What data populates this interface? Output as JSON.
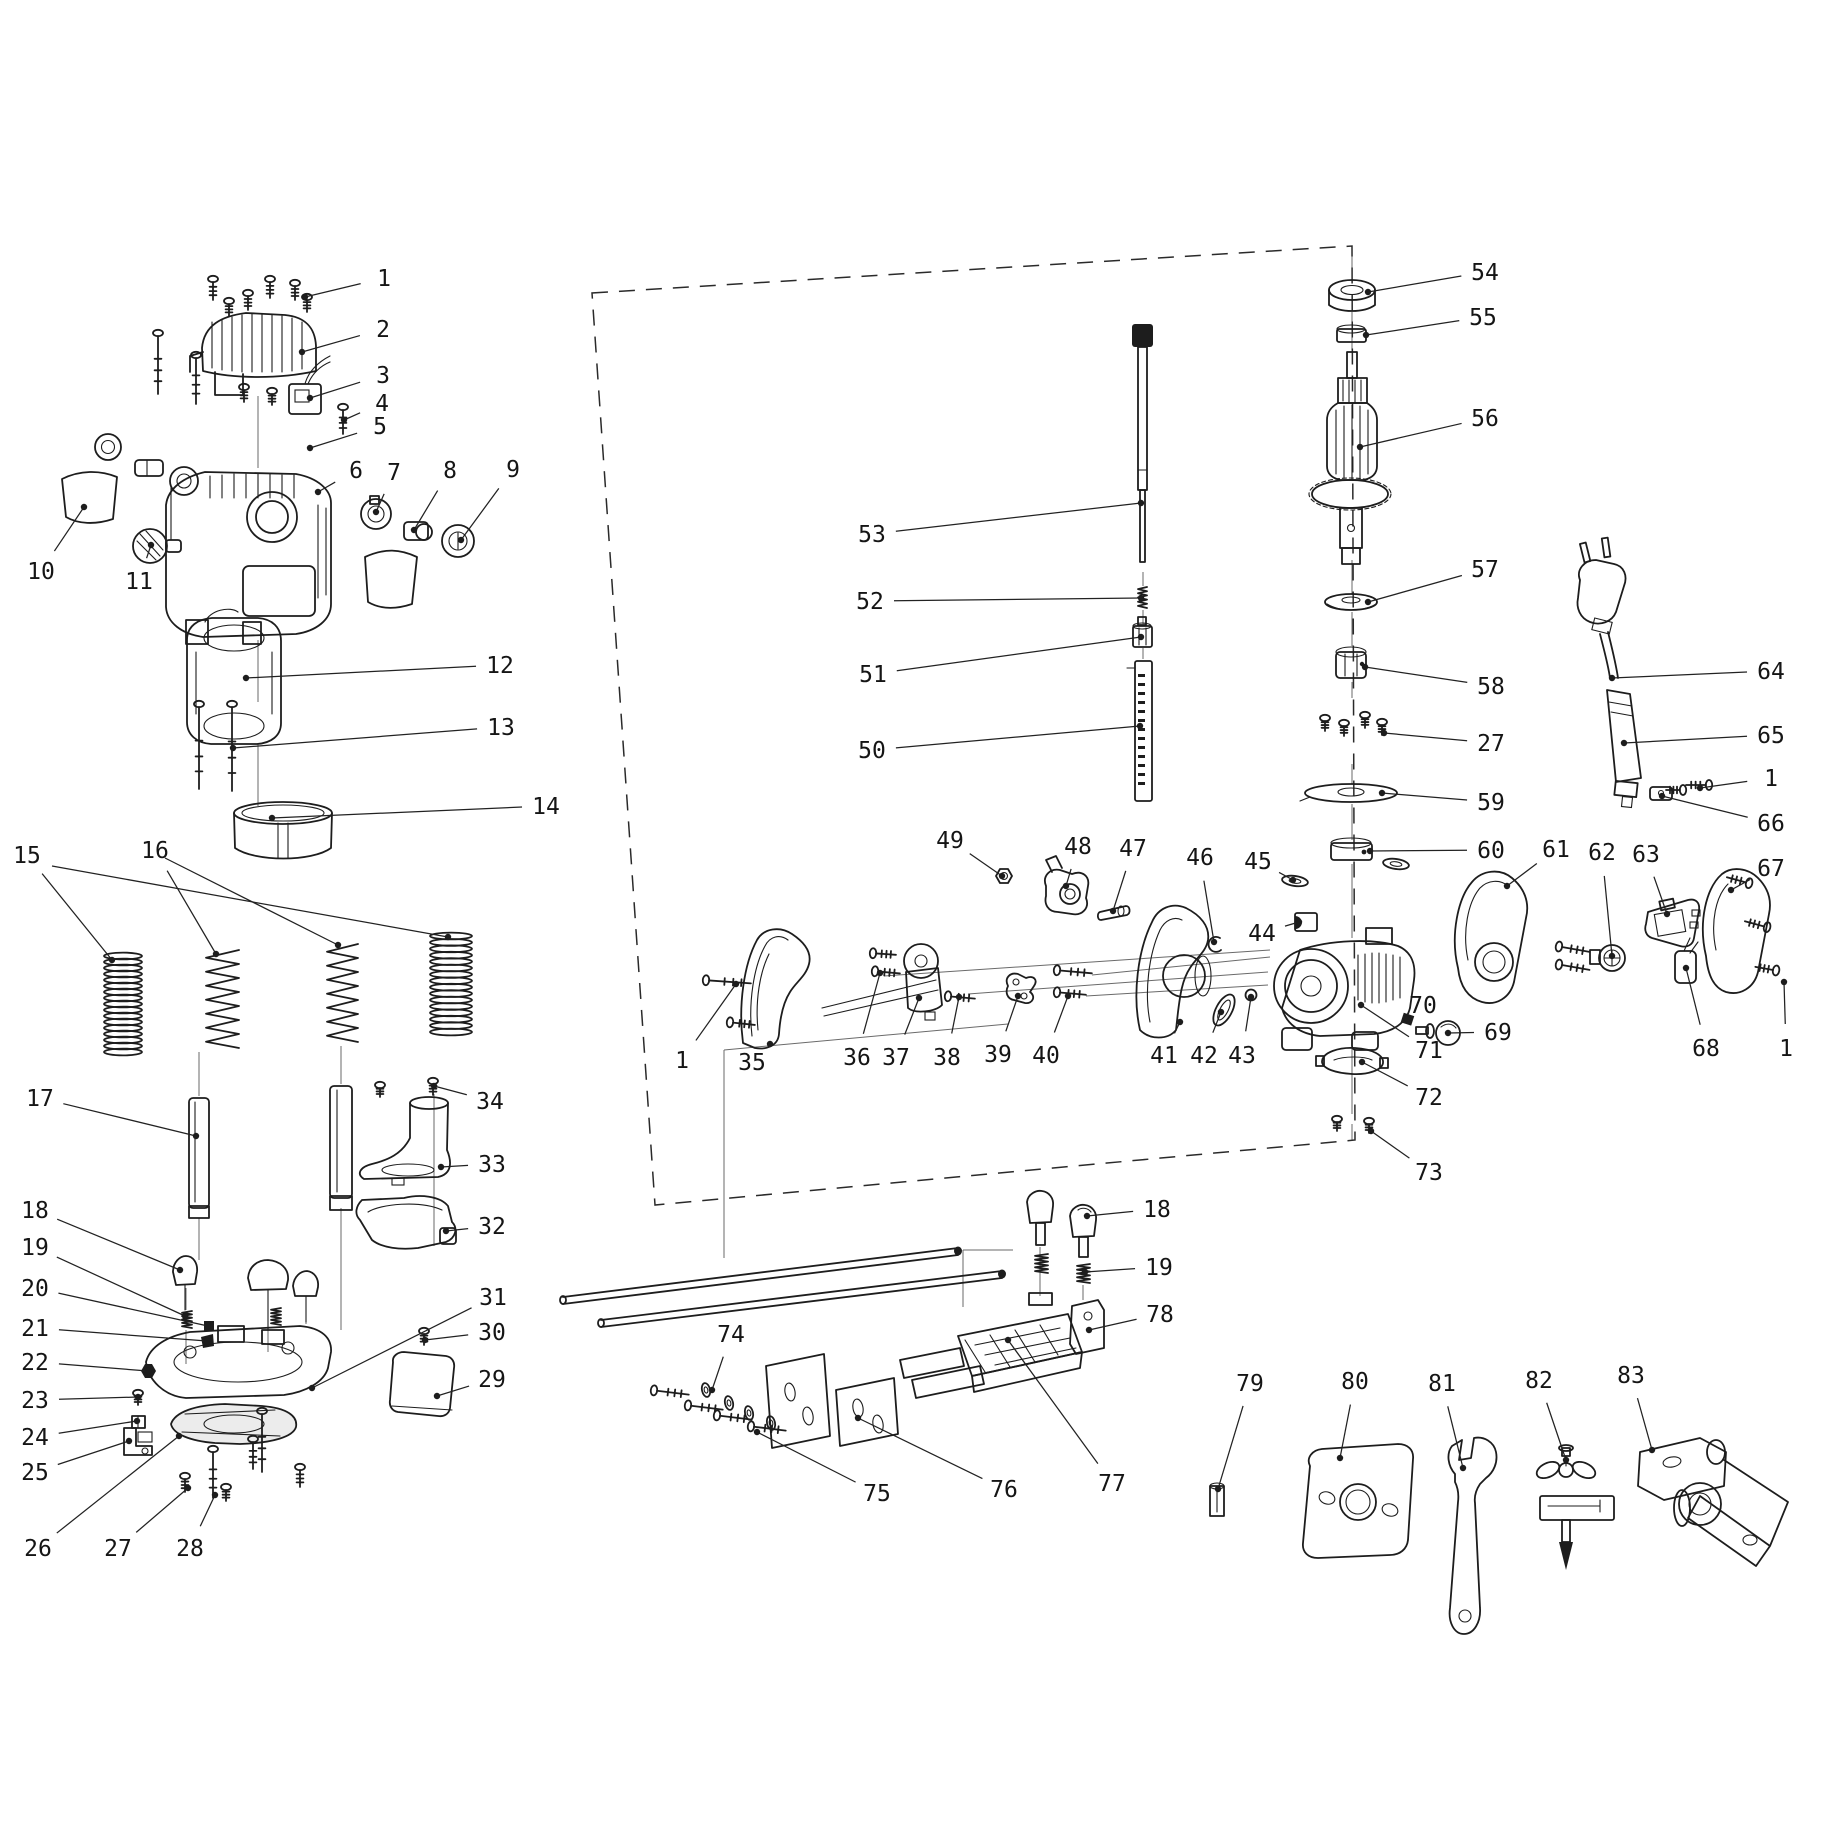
{
  "diagram": {
    "bg": "#ffffff",
    "ink": "#1d1d1d",
    "description_labels_are_part_numbers": true,
    "labels": [
      {
        "n": "1",
        "x": 384,
        "y": 278,
        "tx": 305,
        "ty": 297
      },
      {
        "n": "2",
        "x": 383,
        "y": 329,
        "tx": 302,
        "ty": 352
      },
      {
        "n": "3",
        "x": 383,
        "y": 375,
        "tx": 310,
        "ty": 398
      },
      {
        "n": "4",
        "x": 382,
        "y": 403,
        "tx": 344,
        "ty": 420
      },
      {
        "n": "5",
        "x": 380,
        "y": 426,
        "tx": 310,
        "ty": 448
      },
      {
        "n": "6",
        "x": 356,
        "y": 470,
        "tx": 318,
        "ty": 492
      },
      {
        "n": "7",
        "x": 394,
        "y": 472,
        "tx": 376,
        "ty": 512
      },
      {
        "n": "8",
        "x": 450,
        "y": 470,
        "tx": 414,
        "ty": 530
      },
      {
        "n": "9",
        "x": 513,
        "y": 469,
        "tx": 461,
        "ty": 540
      },
      {
        "n": "10",
        "x": 41,
        "y": 571,
        "tx": 84,
        "ty": 507
      },
      {
        "n": "11",
        "x": 139,
        "y": 581,
        "tx": 151,
        "ty": 545
      },
      {
        "n": "12",
        "x": 500,
        "y": 665,
        "tx": 246,
        "ty": 678
      },
      {
        "n": "13",
        "x": 501,
        "y": 727,
        "tx": 233,
        "ty": 748
      },
      {
        "n": "14",
        "x": 546,
        "y": 806,
        "tx": 272,
        "ty": 818
      },
      {
        "n": "15",
        "x": 27,
        "y": 855,
        "tx": 112,
        "ty": 960
      },
      {
        "n": "16",
        "x": 155,
        "y": 850,
        "tx": 216,
        "ty": 954
      },
      {
        "n": "17",
        "x": 40,
        "y": 1098,
        "tx": 196,
        "ty": 1136
      },
      {
        "n": "18",
        "x": 35,
        "y": 1210,
        "tx": 180,
        "ty": 1270
      },
      {
        "n": "19",
        "x": 35,
        "y": 1247,
        "tx": 185,
        "ty": 1316
      },
      {
        "n": "20",
        "x": 35,
        "y": 1288,
        "tx": 208,
        "ty": 1326
      },
      {
        "n": "21",
        "x": 35,
        "y": 1328,
        "tx": 207,
        "ty": 1341
      },
      {
        "n": "22",
        "x": 35,
        "y": 1362,
        "tx": 148,
        "ty": 1371
      },
      {
        "n": "23",
        "x": 35,
        "y": 1400,
        "tx": 138,
        "ty": 1397
      },
      {
        "n": "24",
        "x": 35,
        "y": 1437,
        "tx": 137,
        "ty": 1421
      },
      {
        "n": "25",
        "x": 35,
        "y": 1472,
        "tx": 129,
        "ty": 1441
      },
      {
        "n": "26",
        "x": 38,
        "y": 1548,
        "tx": 179,
        "ty": 1436
      },
      {
        "n": "27",
        "x": 118,
        "y": 1548,
        "tx": 188,
        "ty": 1488
      },
      {
        "n": "28",
        "x": 190,
        "y": 1548,
        "tx": 215,
        "ty": 1495
      },
      {
        "n": "29",
        "x": 492,
        "y": 1379,
        "tx": 437,
        "ty": 1396
      },
      {
        "n": "30",
        "x": 492,
        "y": 1332,
        "tx": 425,
        "ty": 1340
      },
      {
        "n": "31",
        "x": 493,
        "y": 1297,
        "tx": 312,
        "ty": 1388
      },
      {
        "n": "32",
        "x": 492,
        "y": 1226,
        "tx": 446,
        "ty": 1231
      },
      {
        "n": "33",
        "x": 492,
        "y": 1164,
        "tx": 441,
        "ty": 1167
      },
      {
        "n": "34",
        "x": 490,
        "y": 1101,
        "tx": 434,
        "ty": 1086
      },
      {
        "n": "1",
        "x": 682,
        "y": 1060,
        "tx": 736,
        "ty": 984
      },
      {
        "n": "35",
        "x": 752,
        "y": 1062,
        "tx": 770,
        "ty": 1044
      },
      {
        "n": "36",
        "x": 857,
        "y": 1057,
        "tx": 880,
        "ty": 973
      },
      {
        "n": "37",
        "x": 896,
        "y": 1057,
        "tx": 919,
        "ty": 998
      },
      {
        "n": "38",
        "x": 947,
        "y": 1057,
        "tx": 959,
        "ty": 997
      },
      {
        "n": "39",
        "x": 998,
        "y": 1054,
        "tx": 1018,
        "ty": 996
      },
      {
        "n": "40",
        "x": 1046,
        "y": 1055,
        "tx": 1068,
        "ty": 996
      },
      {
        "n": "41",
        "x": 1164,
        "y": 1055,
        "tx": 1180,
        "ty": 1022
      },
      {
        "n": "42",
        "x": 1204,
        "y": 1055,
        "tx": 1221,
        "ty": 1012
      },
      {
        "n": "43",
        "x": 1242,
        "y": 1055,
        "tx": 1251,
        "ty": 997
      },
      {
        "n": "44",
        "x": 1262,
        "y": 933,
        "tx": 1299,
        "ty": 922
      },
      {
        "n": "45",
        "x": 1258,
        "y": 861,
        "tx": 1293,
        "ty": 880
      },
      {
        "n": "46",
        "x": 1200,
        "y": 857,
        "tx": 1214,
        "ty": 942
      },
      {
        "n": "47",
        "x": 1133,
        "y": 848,
        "tx": 1113,
        "ty": 911
      },
      {
        "n": "48",
        "x": 1078,
        "y": 846,
        "tx": 1066,
        "ty": 886
      },
      {
        "n": "49",
        "x": 950,
        "y": 840,
        "tx": 1002,
        "ty": 876
      },
      {
        "n": "50",
        "x": 872,
        "y": 750,
        "tx": 1140,
        "ty": 726
      },
      {
        "n": "51",
        "x": 873,
        "y": 674,
        "tx": 1141,
        "ty": 637
      },
      {
        "n": "52",
        "x": 870,
        "y": 601,
        "tx": 1141,
        "ty": 598
      },
      {
        "n": "53",
        "x": 872,
        "y": 534,
        "tx": 1141,
        "ty": 503
      },
      {
        "n": "54",
        "x": 1485,
        "y": 272,
        "tx": 1368,
        "ty": 292
      },
      {
        "n": "55",
        "x": 1483,
        "y": 317,
        "tx": 1366,
        "ty": 335
      },
      {
        "n": "56",
        "x": 1485,
        "y": 418,
        "tx": 1360,
        "ty": 447
      },
      {
        "n": "57",
        "x": 1485,
        "y": 569,
        "tx": 1368,
        "ty": 602
      },
      {
        "n": "58",
        "x": 1491,
        "y": 686,
        "tx": 1365,
        "ty": 667
      },
      {
        "n": "27",
        "x": 1491,
        "y": 743,
        "tx": 1384,
        "ty": 733
      },
      {
        "n": "59",
        "x": 1491,
        "y": 802,
        "tx": 1382,
        "ty": 793
      },
      {
        "n": "60",
        "x": 1491,
        "y": 850,
        "tx": 1370,
        "ty": 851
      },
      {
        "n": "61",
        "x": 1556,
        "y": 849,
        "tx": 1507,
        "ty": 886
      },
      {
        "n": "62",
        "x": 1602,
        "y": 852,
        "tx": 1612,
        "ty": 956
      },
      {
        "n": "63",
        "x": 1646,
        "y": 854,
        "tx": 1667,
        "ty": 914
      },
      {
        "n": "64",
        "x": 1771,
        "y": 671,
        "tx": 1612,
        "ty": 678
      },
      {
        "n": "65",
        "x": 1771,
        "y": 735,
        "tx": 1624,
        "ty": 743
      },
      {
        "n": "1",
        "x": 1771,
        "y": 778,
        "tx": 1700,
        "ty": 788
      },
      {
        "n": "66",
        "x": 1771,
        "y": 823,
        "tx": 1662,
        "ty": 796
      },
      {
        "n": "67",
        "x": 1771,
        "y": 868,
        "tx": 1731,
        "ty": 890
      },
      {
        "n": "68",
        "x": 1706,
        "y": 1048,
        "tx": 1686,
        "ty": 968
      },
      {
        "n": "1",
        "x": 1786,
        "y": 1048,
        "tx": 1784,
        "ty": 982
      },
      {
        "n": "69",
        "x": 1498,
        "y": 1032,
        "tx": 1448,
        "ty": 1033
      },
      {
        "n": "70",
        "x": 1423,
        "y": 1005,
        "tx": 1407,
        "ty": 1019
      },
      {
        "n": "71",
        "x": 1429,
        "y": 1050,
        "tx": 1361,
        "ty": 1005
      },
      {
        "n": "72",
        "x": 1429,
        "y": 1097,
        "tx": 1362,
        "ty": 1062
      },
      {
        "n": "73",
        "x": 1429,
        "y": 1172,
        "tx": 1371,
        "ty": 1131
      },
      {
        "n": "18",
        "x": 1157,
        "y": 1209,
        "tx": 1087,
        "ty": 1216
      },
      {
        "n": "19",
        "x": 1159,
        "y": 1267,
        "tx": 1085,
        "ty": 1272
      },
      {
        "n": "78",
        "x": 1160,
        "y": 1314,
        "tx": 1089,
        "ty": 1330
      },
      {
        "n": "74",
        "x": 731,
        "y": 1334,
        "tx": 712,
        "ty": 1390
      },
      {
        "n": "75",
        "x": 877,
        "y": 1493,
        "tx": 757,
        "ty": 1432
      },
      {
        "n": "76",
        "x": 1004,
        "y": 1489,
        "tx": 858,
        "ty": 1418
      },
      {
        "n": "77",
        "x": 1112,
        "y": 1483,
        "tx": 1008,
        "ty": 1340
      },
      {
        "n": "79",
        "x": 1250,
        "y": 1383,
        "tx": 1218,
        "ty": 1489
      },
      {
        "n": "80",
        "x": 1355,
        "y": 1381,
        "tx": 1340,
        "ty": 1458
      },
      {
        "n": "81",
        "x": 1442,
        "y": 1383,
        "tx": 1463,
        "ty": 1468
      },
      {
        "n": "82",
        "x": 1539,
        "y": 1380,
        "tx": 1566,
        "ty": 1460
      },
      {
        "n": "83",
        "x": 1631,
        "y": 1375,
        "tx": 1652,
        "ty": 1450
      }
    ],
    "extra_leaders": [
      [
        52,
        866,
        448,
        937
      ],
      [
        165,
        858,
        338,
        945
      ]
    ],
    "dashed_box": [
      [
        592,
        293
      ],
      [
        1352,
        246
      ],
      [
        1355,
        1140
      ],
      [
        655,
        1205
      ]
    ],
    "axes": [
      [
        258,
        396,
        258,
        468
      ],
      [
        258,
        640,
        258,
        702
      ],
      [
        258,
        744,
        258,
        806
      ],
      [
        199,
        1052,
        199,
        1096
      ],
      [
        199,
        1218,
        199,
        1260
      ],
      [
        341,
        1046,
        341,
        1084
      ],
      [
        341,
        1208,
        341,
        1330
      ],
      [
        186,
        1288,
        186,
        1310
      ],
      [
        186,
        1330,
        186,
        1364
      ],
      [
        268,
        1292,
        268,
        1352
      ],
      [
        306,
        1298,
        306,
        1324
      ],
      [
        434,
        1094,
        434,
        1246
      ],
      [
        1352,
        250,
        1352,
        280
      ],
      [
        1352,
        312,
        1352,
        350
      ],
      [
        1352,
        560,
        1352,
        594
      ],
      [
        1352,
        612,
        1352,
        646
      ],
      [
        1352,
        682,
        1352,
        698
      ],
      [
        1352,
        764,
        1352,
        784
      ],
      [
        1352,
        804,
        1352,
        840
      ],
      [
        1352,
        864,
        1352,
        938
      ],
      [
        1352,
        1042,
        1352,
        1114
      ],
      [
        1352,
        1124,
        1352,
        1140
      ],
      [
        1143,
        572,
        1143,
        586
      ],
      [
        1143,
        610,
        1143,
        624
      ],
      [
        1143,
        648,
        1143,
        659
      ],
      [
        1040,
        1247,
        1040,
        1296
      ],
      [
        1083,
        1285,
        1083,
        1300
      ],
      [
        884,
        976,
        1270,
        950
      ],
      [
        968,
        994,
        1268,
        972
      ],
      [
        1092,
        975,
        1270,
        957
      ],
      [
        1086,
        996,
        1268,
        985
      ],
      [
        724,
        1050,
        724,
        1258
      ],
      [
        724,
        1050,
        1008,
        1024
      ],
      [
        963,
        1250,
        963,
        1307
      ],
      [
        963,
        1250,
        1013,
        1250
      ]
    ],
    "springs": [
      {
        "style": "dense",
        "x": 104,
        "y": 956,
        "w": 38,
        "h": 96,
        "n": 17
      },
      {
        "style": "open",
        "x": 206,
        "y": 950,
        "w": 33,
        "h": 98,
        "n": 7
      },
      {
        "style": "open",
        "x": 327,
        "y": 944,
        "w": 31,
        "h": 98,
        "n": 7
      },
      {
        "style": "dense",
        "x": 430,
        "y": 936,
        "w": 42,
        "h": 96,
        "n": 16
      }
    ],
    "small_springs": [
      [
        182,
        1311,
        10,
        17
      ],
      [
        271,
        1308,
        10,
        17
      ],
      [
        1035,
        1254,
        13,
        19
      ],
      [
        1077,
        1264,
        13,
        19
      ],
      [
        1138,
        587,
        9,
        21
      ]
    ],
    "screws": [
      [
        213,
        276,
        24,
        0
      ],
      [
        229,
        298,
        18,
        0
      ],
      [
        248,
        290,
        20,
        0
      ],
      [
        270,
        276,
        22,
        0
      ],
      [
        295,
        280,
        20,
        0
      ],
      [
        307,
        294,
        18,
        0
      ],
      [
        158,
        330,
        64,
        0
      ],
      [
        196,
        352,
        52,
        0
      ],
      [
        244,
        384,
        18,
        0
      ],
      [
        272,
        388,
        17,
        0
      ],
      [
        343,
        404,
        30,
        0
      ],
      [
        199,
        701,
        88,
        0
      ],
      [
        232,
        701,
        90,
        0
      ],
      [
        380,
        1082,
        15,
        0
      ],
      [
        433,
        1078,
        17,
        0
      ],
      [
        424,
        1328,
        17,
        0
      ],
      [
        138,
        1390,
        15,
        0
      ],
      [
        185,
        1473,
        19,
        0
      ],
      [
        213,
        1446,
        52,
        0
      ],
      [
        226,
        1484,
        17,
        0
      ],
      [
        253,
        1436,
        33,
        0
      ],
      [
        262,
        1408,
        64,
        0
      ],
      [
        300,
        1464,
        23,
        0
      ],
      [
        1337,
        1116,
        15,
        0
      ],
      [
        1369,
        1118,
        15,
        0
      ],
      [
        1325,
        715,
        16,
        0
      ],
      [
        1344,
        720,
        16,
        0
      ],
      [
        1365,
        712,
        16,
        0
      ],
      [
        1382,
        719,
        16,
        0
      ],
      [
        703,
        980,
        48,
        -86
      ],
      [
        727,
        1022,
        28,
        -84
      ],
      [
        870,
        953,
        26,
        -86
      ],
      [
        872,
        971,
        28,
        -85
      ],
      [
        945,
        996,
        30,
        -85
      ],
      [
        1054,
        970,
        38,
        -85
      ],
      [
        1054,
        992,
        32,
        -85
      ],
      [
        1556,
        946,
        34,
        -80
      ],
      [
        1556,
        964,
        34,
        -80
      ],
      [
        1752,
        884,
        26,
        105
      ],
      [
        1770,
        928,
        26,
        105
      ],
      [
        1779,
        971,
        24,
        100
      ],
      [
        1712,
        785,
        26,
        90
      ],
      [
        1686,
        790,
        20,
        90
      ],
      [
        651,
        1390,
        38,
        -83
      ],
      [
        685,
        1405,
        38,
        -83
      ],
      [
        714,
        1415,
        38,
        -83
      ],
      [
        748,
        1426,
        38,
        -83
      ]
    ],
    "rings": [
      [
        706,
        1390,
        4,
        7,
        -12
      ],
      [
        729,
        1403,
        4,
        7,
        -12
      ],
      [
        749,
        1413,
        4,
        7,
        -12
      ],
      [
        771,
        1423,
        4,
        7,
        -12
      ],
      [
        1295,
        881,
        13,
        5,
        8
      ],
      [
        1396,
        864,
        13,
        5,
        8
      ]
    ]
  }
}
